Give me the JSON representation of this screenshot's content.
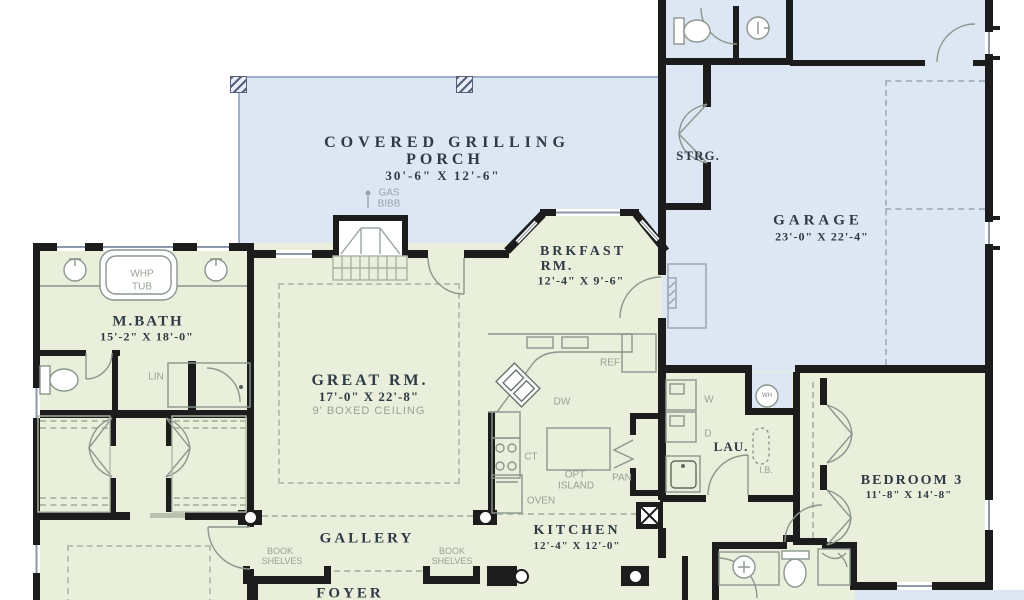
{
  "rooms": {
    "porch": {
      "l1": "COVERED GRILLING",
      "l2": "PORCH",
      "dims": "30'-6\" X 12'-6\""
    },
    "garage": {
      "name": "GARAGE",
      "dims": "23'-0\" X 22'-4\""
    },
    "strg": {
      "name": "STRG."
    },
    "mbath": {
      "name": "M.BATH",
      "dims": "15'-2\" X 18'-0\""
    },
    "great": {
      "name": "GREAT RM.",
      "dims": "17'-0\" X 22'-8\"",
      "note": "9' BOXED CEILING"
    },
    "brkfast": {
      "l1": "BRKFAST",
      "l2": "RM.",
      "dims": "12'-4\" X 9'-6\""
    },
    "kitchen": {
      "name": "KITCHEN",
      "dims": "12'-4\" X 12'-0\""
    },
    "gallery": {
      "name": "GALLERY"
    },
    "foyer": {
      "name": "FOYER"
    },
    "laundry": {
      "name": "LAU."
    },
    "bedroom3": {
      "name": "BEDROOM 3",
      "dims": "11'-8\" X 14'-8\""
    }
  },
  "fixtures": {
    "gas_l1": "GAS",
    "gas_l2": "BIBB",
    "whp_l1": "WHP",
    "whp_l2": "TUB",
    "lin": "LIN",
    "ref": "REF",
    "dw": "DW",
    "ct": "CT",
    "island_l1": "OPT",
    "island_l2": "ISLAND",
    "oven": "OVEN",
    "pan": "PAN",
    "washer": "W",
    "dryer": "D",
    "ironing_board": "I.B.",
    "water_heater": "WH",
    "bookshelf_l1": "BOOK",
    "bookshelf_l2": "SHELVES"
  },
  "colors": {
    "exterior_blue": "#dde6f3",
    "interior_green": "#e9efdb",
    "wall": "#1c1c1c",
    "room_text": "#2e3a45",
    "fixture_text": "#98a294"
  }
}
